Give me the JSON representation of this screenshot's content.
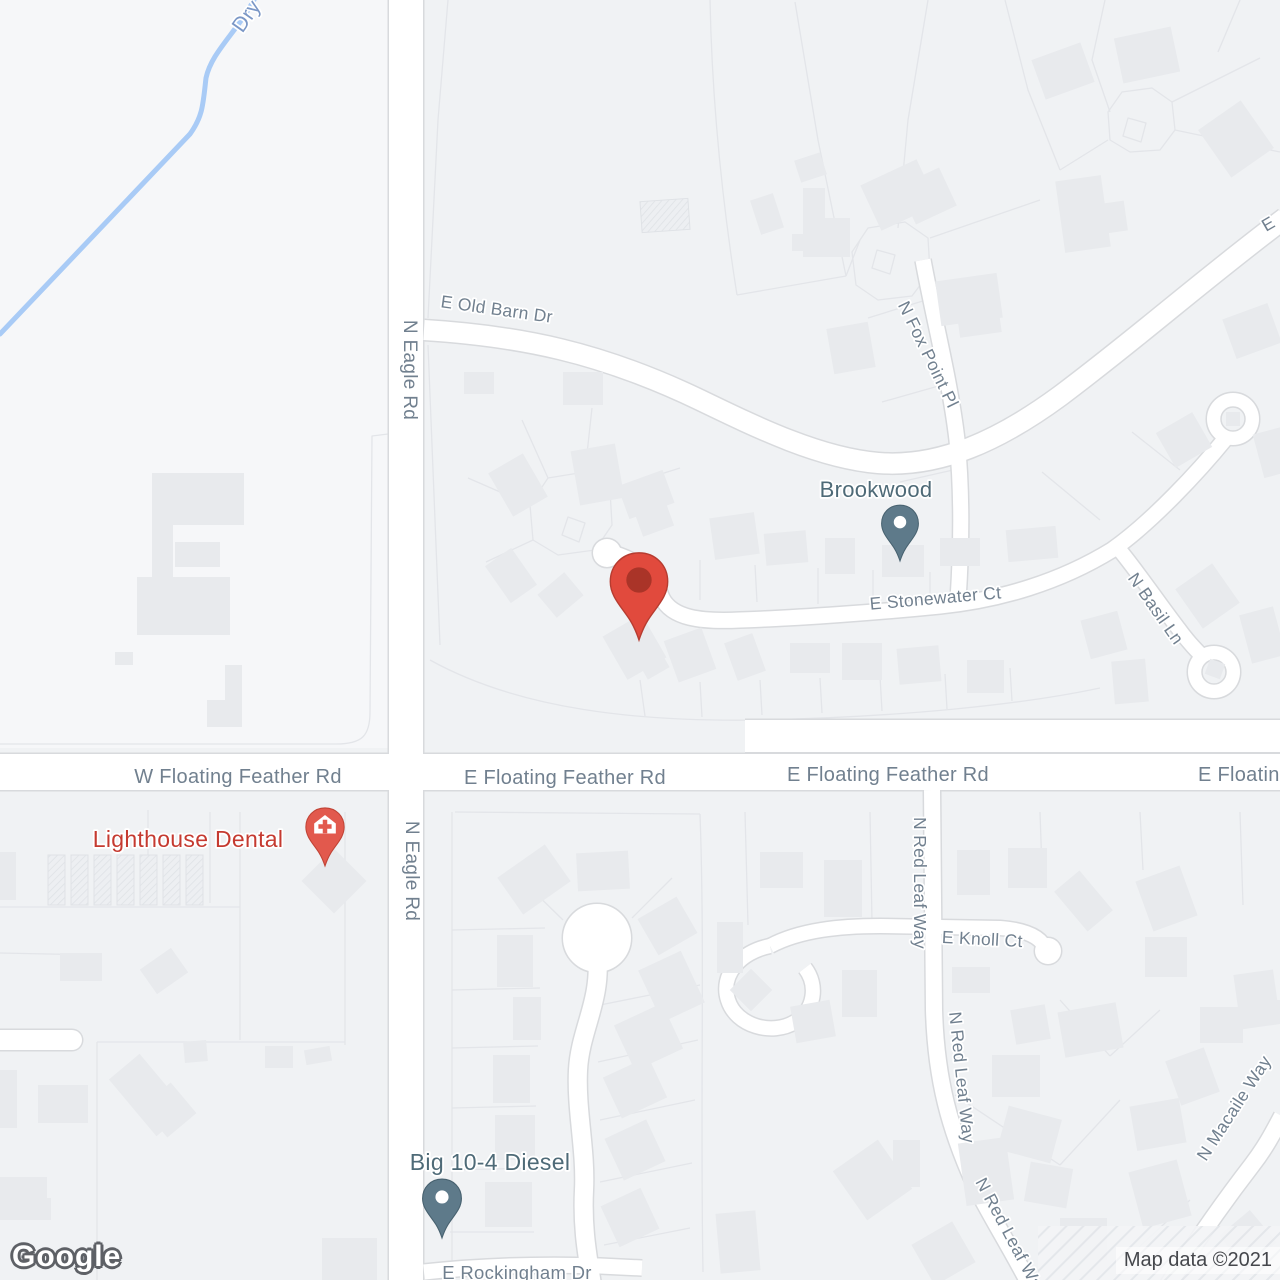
{
  "watermark": {
    "text": "Google"
  },
  "attribution": {
    "text": "Map data ©2021"
  },
  "map": {
    "colors": {
      "bg": "#f0f2f4",
      "field": "#f6f7f9",
      "building": "#e8eaed",
      "building_hatch_bg": "#edeff2",
      "building_hatch_line": "#dfe2e6",
      "parcel": "#e3e5e9",
      "road_fill": "#ffffff",
      "road_casing": "#d8dadd",
      "water": "#a9cbf6",
      "street_label": "#71808f",
      "water_label": "#7b97c6",
      "poi_label": "#4e6a77",
      "poi_red_label": "#c53a30",
      "pin_slate": "#5e7a8a",
      "pin_slate_stroke": "#47616f",
      "pin_red": "#e2594d",
      "pin_red_stroke": "#c04335",
      "marker_red": "#e14a3d",
      "marker_red_stroke": "#b63c30",
      "marker_dot": "#aa3428"
    },
    "fields": [
      {
        "d": "M0 0 H390 V748 H0 Z"
      }
    ],
    "water": {
      "d": "M258 -8 C240 30 212 50 206 78 C203 104 203 116 190 134 L0 334",
      "w": 5
    },
    "roads": [
      {
        "d": "M406 -10 L406 1290",
        "w": 34
      },
      {
        "d": "M-10 772 L1290 772",
        "w": 36
      },
      {
        "d": "M745 736 L1290 736",
        "w": 32
      },
      {
        "d": "M424 330 C520 336 600 352 700 400 C760 429 820 458 878 463 C940 468 1000 440 1060 396 C1140 336 1200 282 1285 218",
        "w": 20
      },
      {
        "d": "M923 260 C934 320 950 380 957 440 C962 490 962 540 958 600",
        "w": 15
      },
      {
        "d": "M606 552 C640 558 654 578 662 598 C672 618 700 622 740 620 C800 618 880 612 940 606 C1000 600 1060 582 1112 550 C1152 522 1200 470 1226 438",
        "w": 15
      },
      {
        "d": "M1118 548 C1138 572 1158 602 1178 628 C1188 642 1198 652 1206 660",
        "w": 14
      },
      {
        "d": "M932 790 L934 1010 C936 1080 950 1130 975 1185 C990 1215 1012 1250 1030 1285",
        "w": 16
      },
      {
        "d": "M770 946 C800 930 840 926 880 926 L1000 928 C1028 930 1042 938 1046 950",
        "w": 14
      },
      {
        "d": "M770 946 C740 952 720 975 728 1000 C736 1026 772 1036 795 1022 C815 1010 818 985 805 968",
        "w": 14
      },
      {
        "d": "M1168 1285 C1198 1238 1225 1200 1252 1165 C1265 1148 1272 1135 1282 1116",
        "w": 16
      },
      {
        "d": "M424 1272 C480 1266 540 1264 600 1266 L642 1268",
        "w": 15
      },
      {
        "d": "M597 955 C602 1000 580 1030 578 1070 C576 1110 586 1150 584 1190 C582 1230 588 1258 592 1285",
        "w": 18
      },
      {
        "d": "M0 1040 L72 1040",
        "w": 20,
        "cap": "round"
      }
    ],
    "bulbs": [
      {
        "cx": 607,
        "cy": 553,
        "r": 14
      },
      {
        "cx": 597,
        "cy": 938,
        "r": 34
      },
      {
        "cx": 1048,
        "cy": 951,
        "r": 13
      }
    ],
    "culdesacs": [
      {
        "cx": 1214,
        "cy": 672,
        "r": 26,
        "ri": 12
      },
      {
        "cx": 1233,
        "cy": 419,
        "r": 26,
        "ri": 12
      }
    ],
    "parcels": [
      "M448 0 L438 120 428 318",
      "M710 0 C712 100 722 200 737 295",
      "M795 2 L818 140 846 276",
      "M928 0 L908 120 898 228",
      "M737 295 L846 276",
      "M860 240 L846 276",
      "M930 238 L1040 200",
      "M1005 0 L1028 90 1060 170",
      "M1105 0 L1092 60 1110 112",
      "M1172 102 L1260 58",
      "M1175 130 L1280 152",
      "M1240 0 L1218 52",
      "M1060 170 L1108 140",
      "M852 252 L868 228 905 222 928 238 930 272 912 296 878 300 856 285 Z",
      "M877 250 L895 255 890 274 872 268 Z",
      "M1108 112 L1122 92 1152 88 1172 102 1175 130 1160 150 1130 152 1110 140 Z",
      "M1128 118 L1146 123 1141 142 1123 136 Z",
      "M530 505 L548 478 585 472 610 490 612 525 595 550 558 555 533 540 Z",
      "M568 517 L585 523 579 542 562 535 Z",
      "M530 505 L468 478",
      "M548 478 L522 420",
      "M585 472 L592 408",
      "M610 490 L680 468",
      "M533 540 L486 562",
      "M0 744 L336 744 C362 744 370 736 370 712 L372 436 388 434",
      "M428 345 C432 450 436 550 440 645",
      "M430 660 C520 710 640 722 760 720 C900 717 1020 705 1100 688",
      "M640 680 L645 716",
      "M700 682 L702 717",
      "M760 680 L762 715",
      "M820 678 L822 713",
      "M880 676 L882 711",
      "M945 674 L947 709",
      "M1010 668 L1012 701",
      "M700 560 L700 600",
      "M755 565 L757 602",
      "M818 568 L818 604",
      "M873 570 L873 604",
      "M930 572 L930 602",
      "M926 300 L868 318",
      "M942 385 L882 402",
      "M953 470 L900 482",
      "M1100 520 L1042 472",
      "M1180 470 L1132 432",
      "M452 812 L452 1272",
      "M452 930 L545 928",
      "M452 990 L540 988",
      "M452 1048 L538 1046",
      "M452 1108 L536 1106",
      "M452 1170 L534 1168",
      "M450 1232 L534 1232",
      "M600 1005 L700 985",
      "M598 1062 L698 1040",
      "M600 1120 L695 1100",
      "M600 1182 L692 1163",
      "M604 1245 L690 1228",
      "M563 920 L520 878",
      "M632 918 L672 878",
      "M700 814 C705 950 700 1100 703 1272",
      "M455 812 L700 814",
      "M745 812 L748 925",
      "M870 812 L872 922",
      "M1040 812 L1042 870",
      "M1140 812 L1143 870",
      "M1240 812 L1243 905",
      "M1060 1000 L1110 1056",
      "M1110 1056 L1160 1010",
      "M955 1095 L1060 1165",
      "M1060 1165 L1120 1100",
      "M1125 1260 L1190 1200",
      "M148 810 L148 905",
      "M210 812 L210 903",
      "M0 907 L240 907",
      "M240 812 L240 1040",
      "M345 812 L345 1045",
      "M97 1042 L345 1042",
      "M97 1042 L97 1280",
      "M0 953 L97 955"
    ],
    "buildings": [
      [
        641,
        200,
        48,
        31,
        -4,
        "h"
      ],
      [
        755,
        196,
        24,
        36,
        -18
      ],
      [
        797,
        156,
        27,
        23,
        -18
      ],
      [
        792,
        234,
        13,
        17,
        0
      ],
      [
        803,
        188,
        22,
        69,
        0
      ],
      [
        803,
        218,
        47,
        39,
        0
      ],
      [
        868,
        170,
        62,
        50,
        -25
      ],
      [
        905,
        175,
        45,
        42,
        -25
      ],
      [
        938,
        277,
        62,
        45,
        -8
      ],
      [
        958,
        307,
        42,
        28,
        -8
      ],
      [
        1037,
        50,
        52,
        42,
        -20
      ],
      [
        1118,
        32,
        58,
        46,
        -12
      ],
      [
        1210,
        110,
        52,
        58,
        -35
      ],
      [
        1060,
        178,
        46,
        72,
        -8
      ],
      [
        1090,
        203,
        36,
        30,
        -8
      ],
      [
        1228,
        310,
        48,
        42,
        -20
      ],
      [
        830,
        325,
        42,
        46,
        -10
      ],
      [
        1163,
        420,
        42,
        40,
        -30
      ],
      [
        1258,
        430,
        30,
        45,
        -15
      ],
      [
        152,
        473,
        21,
        162,
        0
      ],
      [
        152,
        473,
        92,
        52,
        0
      ],
      [
        137,
        577,
        93,
        58,
        0
      ],
      [
        175,
        542,
        45,
        25,
        0
      ],
      [
        115,
        652,
        18,
        13,
        0
      ],
      [
        225,
        665,
        17,
        62,
        0
      ],
      [
        207,
        700,
        35,
        27,
        0
      ],
      [
        464,
        372,
        30,
        22,
        0
      ],
      [
        563,
        372,
        40,
        33,
        0
      ],
      [
        575,
        447,
        45,
        55,
        -10
      ],
      [
        498,
        460,
        40,
        50,
        -30
      ],
      [
        622,
        477,
        48,
        35,
        -20
      ],
      [
        637,
        502,
        33,
        30,
        -20
      ],
      [
        712,
        515,
        45,
        42,
        -8
      ],
      [
        765,
        532,
        42,
        32,
        -5
      ],
      [
        825,
        538,
        30,
        36,
        0
      ],
      [
        882,
        545,
        42,
        32,
        0
      ],
      [
        940,
        538,
        40,
        28,
        0
      ],
      [
        1007,
        528,
        50,
        32,
        -5
      ],
      [
        495,
        553,
        32,
        45,
        -35
      ],
      [
        543,
        580,
        35,
        30,
        -40
      ],
      [
        612,
        622,
        45,
        50,
        -30
      ],
      [
        640,
        650,
        25,
        25,
        -30
      ],
      [
        670,
        633,
        40,
        44,
        -20
      ],
      [
        730,
        637,
        30,
        40,
        -20
      ],
      [
        790,
        643,
        40,
        30,
        0
      ],
      [
        842,
        643,
        40,
        37,
        0
      ],
      [
        898,
        647,
        42,
        36,
        -5
      ],
      [
        967,
        660,
        37,
        33,
        0
      ],
      [
        1085,
        615,
        38,
        40,
        -15
      ],
      [
        1113,
        660,
        34,
        43,
        -5
      ],
      [
        1185,
        572,
        45,
        48,
        -35
      ],
      [
        1245,
        610,
        35,
        50,
        -15
      ],
      [
        1207,
        661,
        16,
        16,
        20
      ],
      [
        1226,
        412,
        14,
        14,
        0
      ],
      [
        48,
        855,
        17,
        50,
        0,
        "h"
      ],
      [
        71,
        855,
        17,
        50,
        0,
        "h"
      ],
      [
        94,
        855,
        17,
        50,
        0,
        "h"
      ],
      [
        117,
        855,
        17,
        50,
        0,
        "h"
      ],
      [
        140,
        855,
        17,
        50,
        0,
        "h"
      ],
      [
        163,
        855,
        17,
        50,
        0,
        "h"
      ],
      [
        186,
        855,
        17,
        50,
        0,
        "h"
      ],
      [
        0,
        852,
        16,
        48,
        0
      ],
      [
        311,
        858,
        46,
        46,
        45
      ],
      [
        60,
        953,
        42,
        28,
        0
      ],
      [
        145,
        956,
        38,
        30,
        -35
      ],
      [
        0,
        1070,
        17,
        58,
        0
      ],
      [
        38,
        1085,
        50,
        38,
        0
      ],
      [
        0,
        1177,
        47,
        43,
        0
      ],
      [
        128,
        1058,
        40,
        74,
        -40
      ],
      [
        150,
        1090,
        38,
        40,
        -40
      ],
      [
        184,
        1041,
        23,
        21,
        -5
      ],
      [
        265,
        1046,
        28,
        22,
        0
      ],
      [
        305,
        1048,
        26,
        15,
        -10
      ],
      [
        13,
        1198,
        38,
        22,
        0
      ],
      [
        322,
        1238,
        55,
        42,
        0
      ],
      [
        505,
        857,
        58,
        45,
        -35
      ],
      [
        577,
        852,
        52,
        38,
        -3
      ],
      [
        497,
        935,
        36,
        52,
        0
      ],
      [
        513,
        997,
        28,
        43,
        0
      ],
      [
        493,
        1055,
        37,
        48,
        0
      ],
      [
        495,
        1115,
        40,
        45,
        0
      ],
      [
        485,
        1182,
        47,
        45,
        0
      ],
      [
        645,
        905,
        45,
        42,
        -30
      ],
      [
        648,
        958,
        47,
        57,
        -25
      ],
      [
        622,
        1012,
        53,
        50,
        -25
      ],
      [
        610,
        1065,
        50,
        45,
        -25
      ],
      [
        612,
        1127,
        46,
        46,
        -25
      ],
      [
        608,
        1195,
        44,
        45,
        -25
      ],
      [
        760,
        852,
        43,
        36,
        0
      ],
      [
        824,
        860,
        38,
        57,
        0
      ],
      [
        957,
        850,
        33,
        45,
        0
      ],
      [
        1008,
        848,
        39,
        40,
        0
      ],
      [
        1067,
        875,
        33,
        52,
        -40
      ],
      [
        1143,
        872,
        47,
        53,
        -20
      ],
      [
        1145,
        937,
        42,
        40,
        0
      ],
      [
        717,
        922,
        26,
        51,
        0
      ],
      [
        842,
        970,
        35,
        47,
        0
      ],
      [
        952,
        967,
        38,
        26,
        0
      ],
      [
        1013,
        1007,
        35,
        35,
        -10
      ],
      [
        736,
        975,
        30,
        30,
        45
      ],
      [
        1237,
        972,
        40,
        55,
        -8
      ],
      [
        793,
        1003,
        40,
        37,
        -10
      ],
      [
        1061,
        1007,
        59,
        46,
        -10
      ],
      [
        1200,
        1007,
        43,
        36,
        0
      ],
      [
        1263,
        1000,
        17,
        20,
        0
      ],
      [
        1172,
        1053,
        41,
        47,
        -20
      ],
      [
        992,
        1055,
        48,
        42,
        0
      ],
      [
        1133,
        1102,
        50,
        45,
        -10
      ],
      [
        1002,
        1112,
        55,
        45,
        15
      ],
      [
        1027,
        1165,
        43,
        40,
        10
      ],
      [
        1135,
        1165,
        50,
        58,
        -15
      ],
      [
        1060,
        1218,
        47,
        42,
        0
      ],
      [
        1228,
        1218,
        40,
        42,
        -40
      ],
      [
        893,
        1140,
        27,
        47,
        0
      ],
      [
        920,
        1230,
        47,
        47,
        -30
      ],
      [
        718,
        1212,
        40,
        60,
        -5
      ],
      [
        845,
        1150,
        55,
        60,
        -35
      ],
      [
        962,
        1140,
        48,
        63,
        -8
      ]
    ],
    "hatch_corner": {
      "x": 1038,
      "y": 1226,
      "w": 242,
      "h": 54
    },
    "labels": [
      {
        "t": "Dry",
        "x": 252,
        "y": 20,
        "r": -55,
        "s": 21,
        "c": "water"
      },
      {
        "t": "N Eagle Rd",
        "x": 404,
        "y": 370,
        "r": 90,
        "s": 19,
        "c": "st"
      },
      {
        "t": "N Eagle Rd",
        "x": 406,
        "y": 871,
        "r": 90,
        "s": 19,
        "c": "st"
      },
      {
        "t": "E Old Barn Dr",
        "x": 496,
        "y": 315,
        "r": 8,
        "s": 17.5,
        "c": "st"
      },
      {
        "t": "N Fox Point Pl",
        "x": 923,
        "y": 357,
        "r": 64,
        "s": 17.5,
        "c": "st"
      },
      {
        "t": "E Stonewater Ct",
        "x": 936,
        "y": 604,
        "r": -5,
        "s": 17.5,
        "c": "st"
      },
      {
        "t": "N Basil Ln",
        "x": 1151,
        "y": 612,
        "r": 55,
        "s": 17.5,
        "c": "st"
      },
      {
        "t": "W Floating Feather Rd",
        "x": 238,
        "y": 783,
        "r": 0,
        "s": 20,
        "c": "st"
      },
      {
        "t": "E Floating Feather Rd",
        "x": 565,
        "y": 784,
        "r": 0,
        "s": 20,
        "c": "st"
      },
      {
        "t": "E Floating Feather Rd",
        "x": 888,
        "y": 781,
        "r": 0,
        "s": 20,
        "c": "st"
      },
      {
        "t": "E Floating Feather Rd",
        "x": 1198,
        "y": 781,
        "r": 0,
        "s": 20,
        "c": "st",
        "a": "start"
      },
      {
        "t": "N Red Leaf Way",
        "x": 914,
        "y": 883,
        "r": 90,
        "s": 17.5,
        "c": "st"
      },
      {
        "t": "N Red Leaf Way",
        "x": 956,
        "y": 1078,
        "r": 84,
        "s": 17.5,
        "c": "st"
      },
      {
        "t": "N Red Leaf Way",
        "x": 1006,
        "y": 1240,
        "r": 62,
        "s": 17.5,
        "c": "st"
      },
      {
        "t": "E Knoll Ct",
        "x": 982,
        "y": 945,
        "r": 3,
        "s": 17.5,
        "c": "st"
      },
      {
        "t": "N Macaile Way",
        "x": 1206,
        "y": 1162,
        "r": -57,
        "s": 17.5,
        "c": "st",
        "a": "start"
      },
      {
        "t": "E Rockingham Dr",
        "x": 517,
        "y": 1279,
        "r": 0,
        "s": 18.5,
        "c": "st"
      },
      {
        "t": "E",
        "x": 1266,
        "y": 232,
        "r": -30,
        "s": 17.5,
        "c": "st",
        "a": "start"
      },
      {
        "t": "Brookwood",
        "x": 876,
        "y": 497,
        "r": 0,
        "s": 22,
        "c": "poi"
      },
      {
        "t": "Lighthouse Dental",
        "x": 188,
        "y": 847,
        "r": 0,
        "s": 23,
        "c": "poired"
      },
      {
        "t": "Big 10-4 Diesel",
        "x": 490,
        "y": 1170,
        "r": 0,
        "s": 23,
        "c": "poi"
      }
    ],
    "pins": [
      {
        "name": "brookwood-pin",
        "x": 900,
        "y": 561,
        "scale": 1.27,
        "type": "slate"
      },
      {
        "name": "big-10-4-diesel-pin",
        "x": 442,
        "y": 1238,
        "scale": 1.34,
        "type": "slate"
      },
      {
        "name": "lighthouse-dental-pin",
        "x": 325,
        "y": 866,
        "scale": 1.32,
        "type": "red-medical"
      }
    ],
    "marker": {
      "name": "red-location-marker",
      "x": 639,
      "y": 640,
      "scale": 1.98
    }
  }
}
